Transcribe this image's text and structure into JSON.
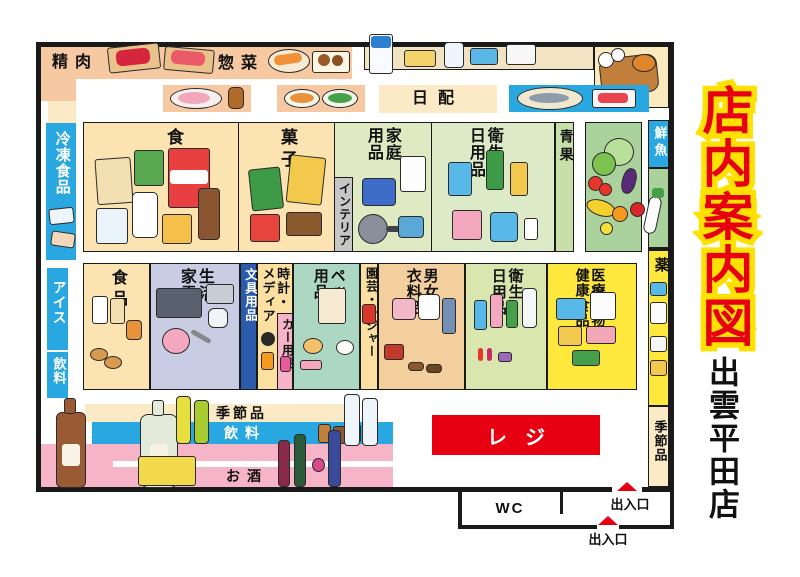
{
  "title": "店内案内図",
  "store_name": "出雲平田店",
  "colors": {
    "title_red": "#e60012",
    "title_outline_yellow": "#ffe100",
    "register_red": "#e60012",
    "entrance_triangle_red": "#e60012",
    "aisle_blue": "#29a7e0",
    "stationery_blue": "#2b5cac",
    "medicine_yellow": "#ffe83e",
    "meat_band_salmon": "#f7c9a3",
    "grocery_tan": "#fce4b2",
    "border_black": "#1a1a1a"
  },
  "sections": {
    "meat": "精肉",
    "deli": "惣菜",
    "daily_delivery": "日配",
    "frozen": "冷凍食品",
    "ice": "アイス",
    "beverage_side": "飲料",
    "food_top": "食品",
    "snacks": "菓子",
    "interior": "インテリア",
    "household": "家庭\n用品",
    "hygiene_top": "衛生\n日用品",
    "produce": "青果",
    "fresh_fish": "鮮魚",
    "food_bottom": "食品",
    "appliances": "生活\n家電",
    "stationery": "文具用品",
    "watch_media": "時計・\nメディア",
    "car": "カー用品",
    "pet": "ペット\n用品",
    "garden": "園芸・レジャー",
    "clothing": "男女\n衣料品",
    "hygiene_bottom": "衛生\n日用品",
    "medical": "医療小物\n健康食品",
    "medicine": "薬",
    "seasonal_side": "季節品",
    "seasonal_shelf": "季節品",
    "beverage_shelf": "飲料",
    "alcohol_shelf": "お酒",
    "register": "レジ",
    "wc": "WC",
    "exit_right": "出入口",
    "exit_bottom": "出入口"
  },
  "illustrations": [
    "meat-boards",
    "deli-fried-foods",
    "dairy-products",
    "fried-fish-display",
    "ham-plate",
    "salad-plates",
    "grilled-fish-sashimi",
    "grocery-items",
    "snack-items",
    "household-items",
    "toiletry-items",
    "vegetables",
    "daikon",
    "frozen-items",
    "bread-milk",
    "appliance-items",
    "media-items",
    "pet-items",
    "garden-item",
    "clothing-items",
    "cosmetic-items",
    "health-boxes",
    "drug-packs",
    "alcohol-bottles",
    "beverage-bottles"
  ]
}
